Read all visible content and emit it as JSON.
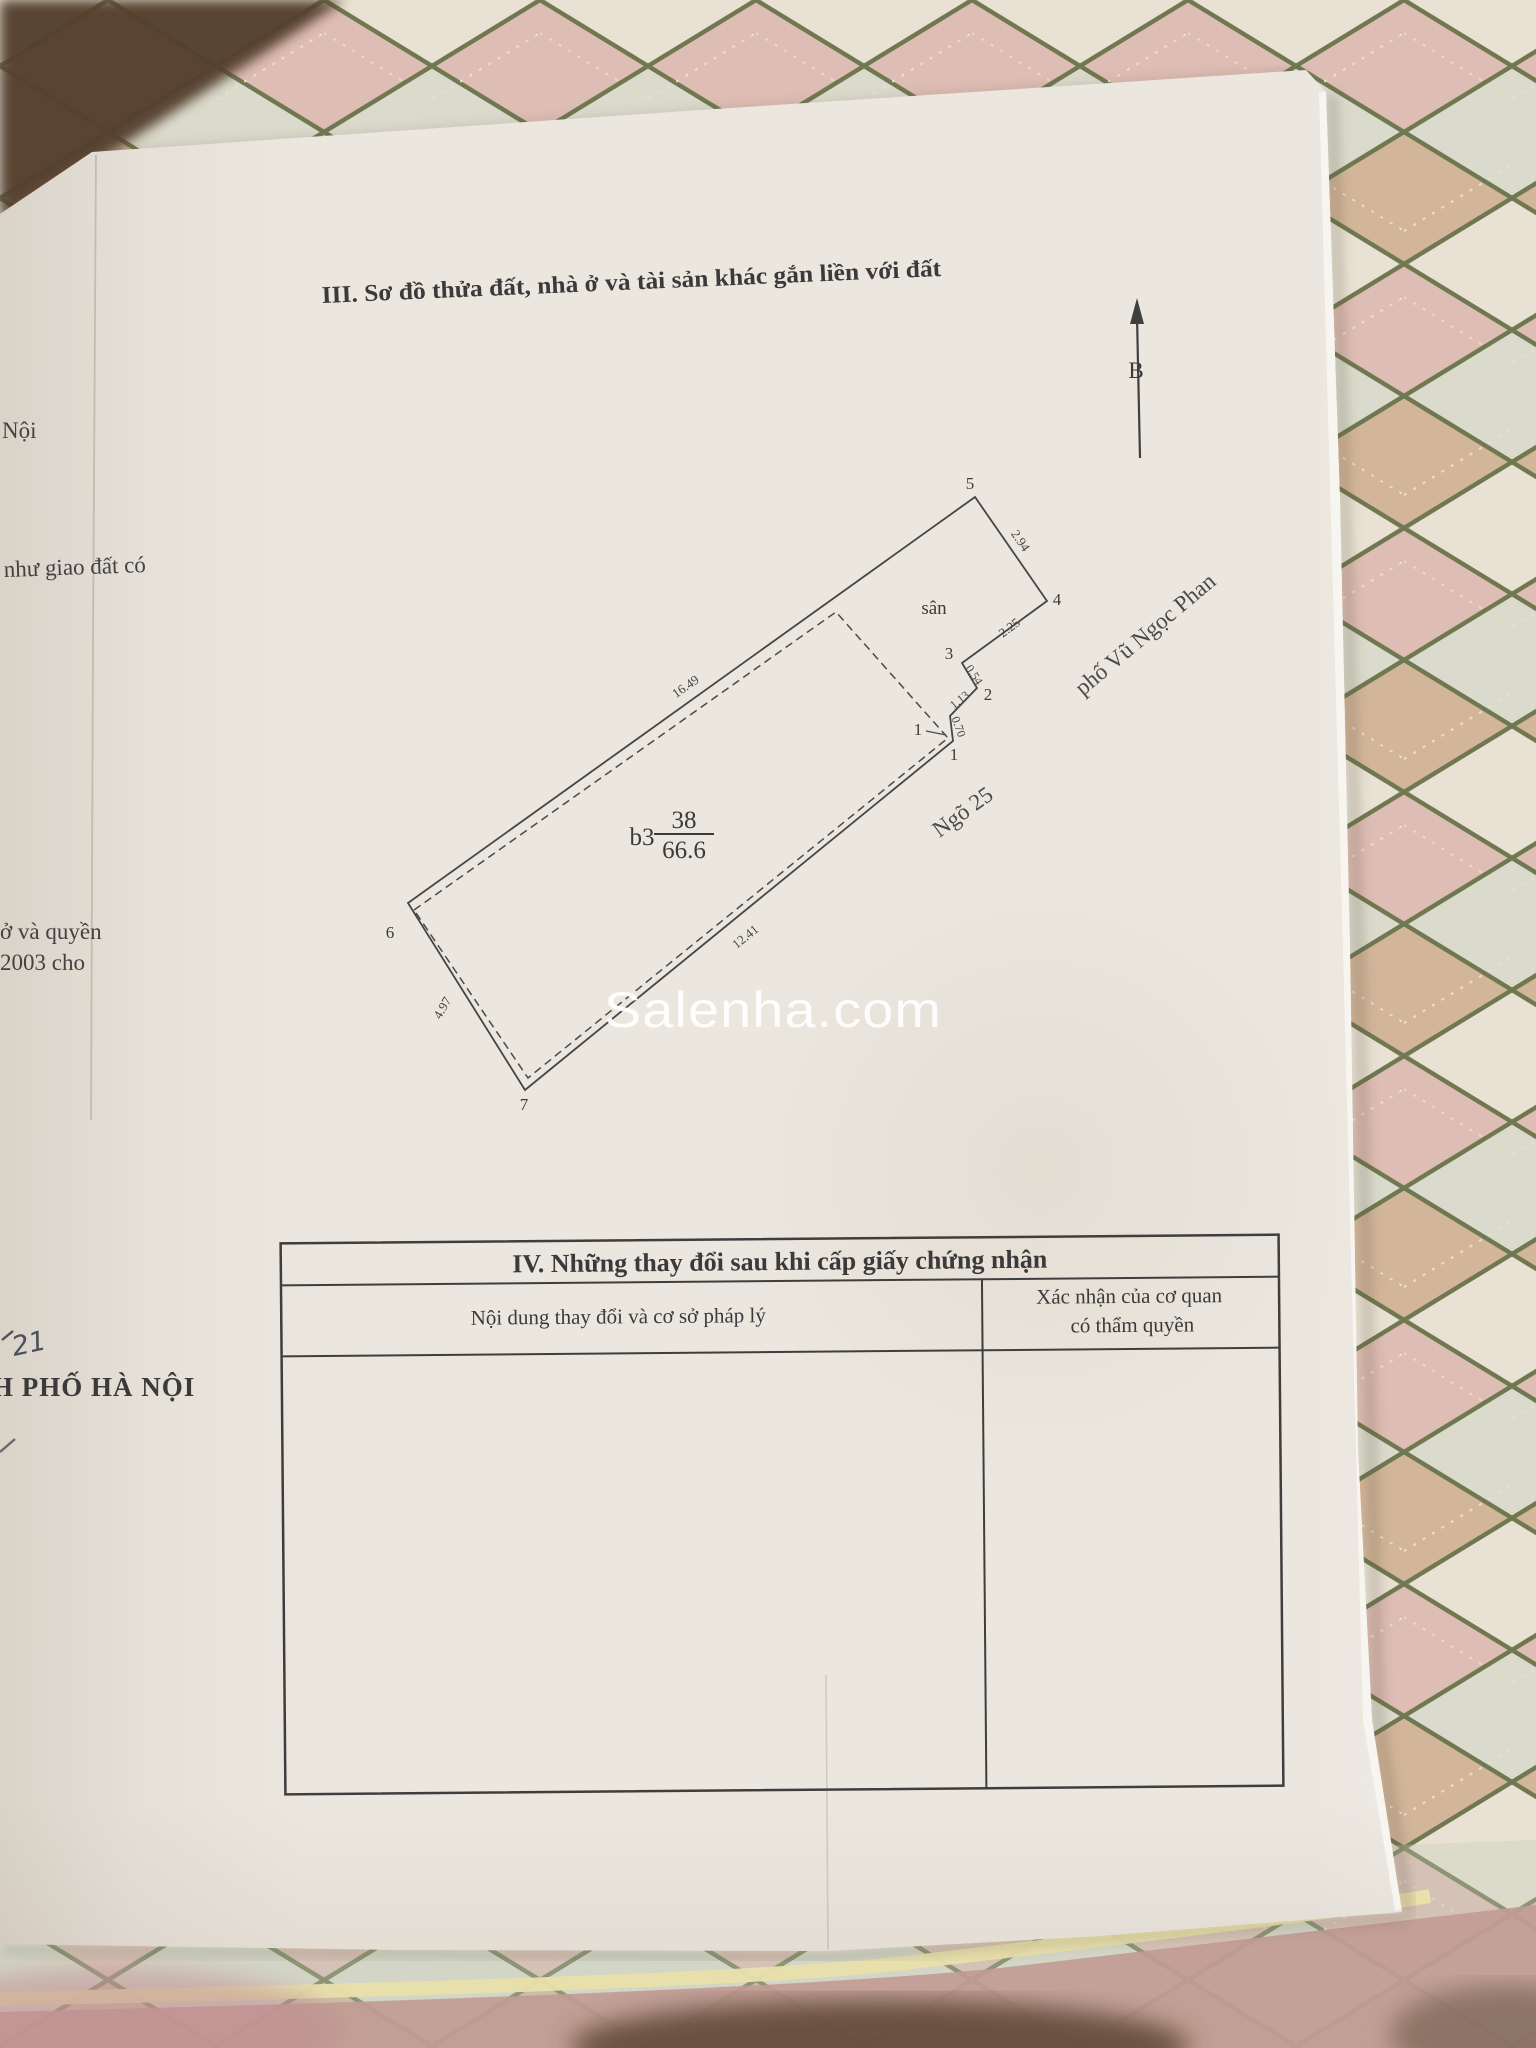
{
  "photo": {
    "watermark_text": "Salenha.com"
  },
  "certificate": {
    "section_iii_title": "III. Sơ đồ thửa đất, nhà ở và tài sản khác gắn liền với đất",
    "compass_north_label": "B",
    "plot_diagram": {
      "yard_label": "sân",
      "house_code": "b3",
      "parcel_number": "38",
      "parcel_area": "66.6",
      "alley_name": "Ngõ 25",
      "street_name": "phố Vũ Ngọc Phan",
      "vertices": {
        "v5": "5",
        "v4": "4",
        "v3": "3",
        "v2": "2",
        "v1_left": "1",
        "v1": "1",
        "v6": "6",
        "v7": "7"
      },
      "edge_lengths": {
        "e54": "2.94",
        "e43": "2.25",
        "e32": "0.54",
        "e2c": "1.13",
        "ec1": "0.70",
        "nw": "16.49",
        "se": "12.41",
        "sw": "4.97"
      }
    },
    "section_iv": {
      "title": "IV. Những thay đổi sau khi cấp giấy chứng nhận",
      "col_change_header": "Nội dung thay đổi và cơ sở pháp lý",
      "col_confirm_header_line1": "Xác nhận của cơ quan",
      "col_confirm_header_line2": "có thẩm quyền"
    },
    "edge_text_fragments": {
      "noi": "Nội",
      "nhu_giao_dat_co": "như giao đất có",
      "o_va_quyen": "ở và quyền",
      "nam_2003_cho": "2003 cho",
      "handwritten_21": "21",
      "pho_ha_noi": "H PHỐ HÀ NỘI"
    }
  },
  "colors": {
    "paper": "#ebe7df",
    "ink": "#3a3a3a",
    "watermark": "#ffffff",
    "fabric_pink": "#debdb4",
    "fabric_tan": "#d3b69a",
    "fabric_cream": "#e9e2d4",
    "fabric_sage": "#d6d8ca",
    "fabric_green_line": "#6f7850",
    "fabric_dark_corner": "#54412f",
    "piping_yellow": "#e8e0ac"
  }
}
